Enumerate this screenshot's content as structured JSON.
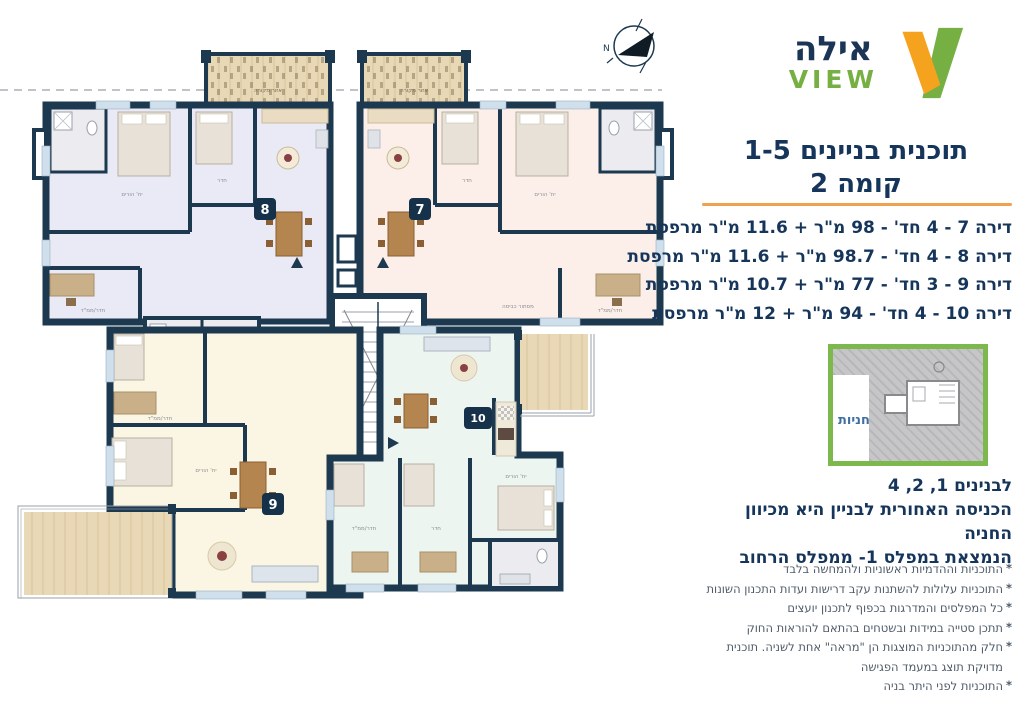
{
  "logo": {
    "hebrew": "אילה",
    "latin": "VIEW"
  },
  "header": {
    "title_line1": "תוכנית בניינים 1-5",
    "title_line2": "קומה 2"
  },
  "apartments": [
    "דירה 7 - 4 חד' - 98 מ\"ר + 11.6 מ\"ר מרפסת",
    "דירה 8 - 4 חד' - 98.7 מ\"ר + 11.6 מ\"ר מרפסת",
    "דירה 9 - 3 חד' - 77 מ\"ר + 10.7 מ\"ר מרפסת",
    "דירה 10 - 4 חד' - 94 מ\"ר + 12 מ\"ר מרפסת"
  ],
  "note": {
    "line1": "לבנינים 1, 2, 4",
    "line2": "הכניסה האחורית לבניין היא מכיוון החניה",
    "line3": "הנמצאת במפלס 1- ממפלס הרחוב"
  },
  "bullet_char": "*",
  "disclaimers": [
    "התוכניות וההדמיות ראשוניות ולהמחשה בלבד",
    "התוכניות עלולות להשתנות עקב דרישות ועדות התכנון השונות",
    "כל המפלסים והמדרגות בכפוף לתכנון יועצים",
    "תתכן סטייה במידות ובשטחים בהתאם להוראות החוק",
    "חלק מהתוכניות המוצגות הן \"מראה\" אחת לשניה. תוכנית מדויקת תוצג במעמד הפגישה",
    "התוכניות לפני היתר בניה"
  ],
  "plan": {
    "labels": {
      "covered_area": "אזור מקורה",
      "laundry": "מסתור כביסה",
      "master": "יח' הורים",
      "room": "חדר",
      "room_mamad": "חדר/ממ\"ד",
      "parking": "חניות",
      "north": "N"
    },
    "units": {
      "b7": "7",
      "b8": "8",
      "b9": "9",
      "b10": "10"
    }
  },
  "colors": {
    "accent_orange": "#F0A14E",
    "brand_green": "#76B043",
    "brand_orange": "#F5A31F",
    "navy_text": "#16355A",
    "wall_navy": "#1D3950",
    "apt7_fill": "#FCEFE9",
    "apt8_fill": "#EAEAF6",
    "apt9_fill": "#FAF6E3",
    "apt10_fill": "#EDF5F0",
    "wood": "#E9D8B6"
  }
}
